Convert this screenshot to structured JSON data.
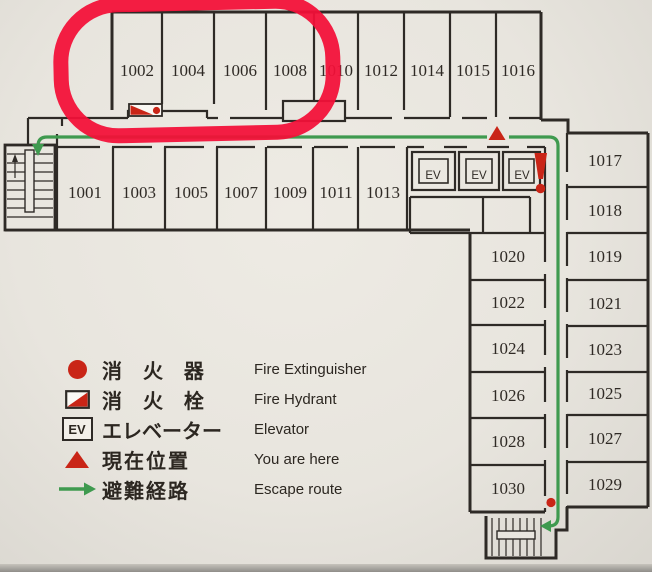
{
  "map": {
    "rooms": {
      "top_row": [
        "1002",
        "1004",
        "1006",
        "1008",
        "1010",
        "1012",
        "1014",
        "1015",
        "1016"
      ],
      "bottom_row": [
        "1001",
        "1003",
        "1005",
        "1007",
        "1009",
        "1011",
        "1013"
      ],
      "right_wing_inner": [
        "1020",
        "1022",
        "1024",
        "1026",
        "1028",
        "1030"
      ],
      "right_wing_outer": [
        "1017",
        "1018",
        "1019",
        "1021",
        "1023",
        "1025",
        "1027",
        "1029"
      ]
    },
    "elevator_label": "EV",
    "elevator_count": 3,
    "highlighted_rooms": [
      "1002",
      "1004",
      "1006",
      "1008"
    ]
  },
  "legend": {
    "elevator_icon_label": "EV",
    "items": [
      {
        "icon": "fire-extinguisher-icon",
        "jp": "消 火 器",
        "en": "Fire Extinguisher"
      },
      {
        "icon": "fire-hydrant-icon",
        "jp": "消 火 栓",
        "en": "Fire Hydrant"
      },
      {
        "icon": "elevator-icon",
        "jp": "エレベーター",
        "en": "Elevator"
      },
      {
        "icon": "you-are-here-icon",
        "jp": "現在位置",
        "en": "You are here"
      },
      {
        "icon": "escape-route-icon",
        "jp": "避難経路",
        "en": "Escape route"
      }
    ]
  },
  "colors": {
    "background": "#e9e6df",
    "wall": "#2e2a26",
    "escape_route_green": "#3f9a4f",
    "alert_red": "#c92517",
    "highlight_red": "#f31038"
  }
}
